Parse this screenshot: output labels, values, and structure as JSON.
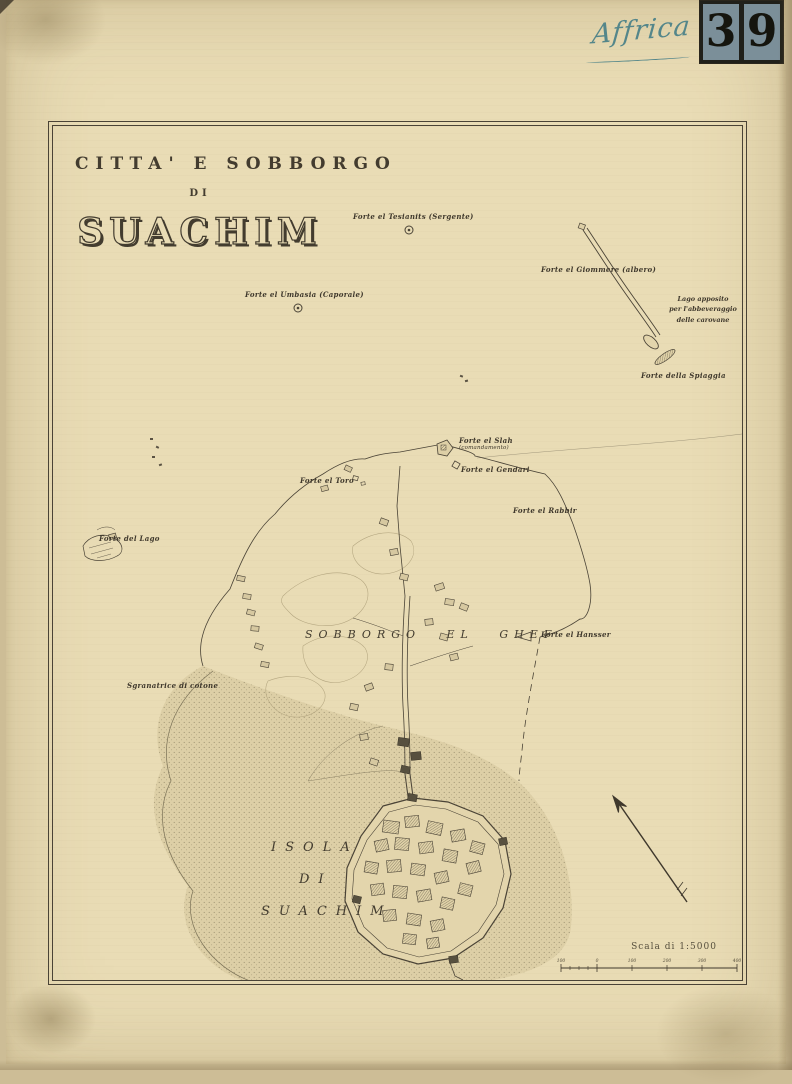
{
  "archive": {
    "handwritten_note": "Affrica",
    "number_digits": [
      "3",
      "9"
    ]
  },
  "title": {
    "line1": "CITTA' E SOBBORGO",
    "line2": "DI",
    "line3": "SUACHIM"
  },
  "labels": {
    "fort_tesianits": "Forte el Tesianits (Sergente)",
    "fort_giommere": "Forte el Giommere (albero)",
    "lago_note_line1": "Lago apposito",
    "lago_note_line2": "per l'abbeveraggio",
    "lago_note_line3": "delle carovane",
    "fort_spiaggia": "Forte della Spiaggia",
    "fort_umbasia": "Forte el Umbasia (Caporale)",
    "fort_slah": "Forte el Slah",
    "fort_slah_note": "(comandamento)",
    "fort_gendari": "Forte el Gendari",
    "fort_toro": "Forte el Toro",
    "fort_rabbir": "Forte el Rabbir",
    "fort_lago": "Forte del Lago",
    "fort_hansser": "Forte el Hansser",
    "cotton_gin": "Sgranatrice di cotone",
    "suburb": "SOBBORGO EL GHEF",
    "island_line1": "ISOLA",
    "island_line2": "DI",
    "island_line3": "SUACHIM"
  },
  "scale": {
    "caption": "Scala di 1:5000",
    "ticks": [
      "100",
      "0",
      "100",
      "200",
      "300",
      "400"
    ]
  },
  "colors": {
    "paper": "#e9dcb5",
    "ink": "#3f382c",
    "stamp_background": "#7b8f99",
    "handwriting_ink": "#54868a",
    "water_stipple": "#968b6e"
  }
}
